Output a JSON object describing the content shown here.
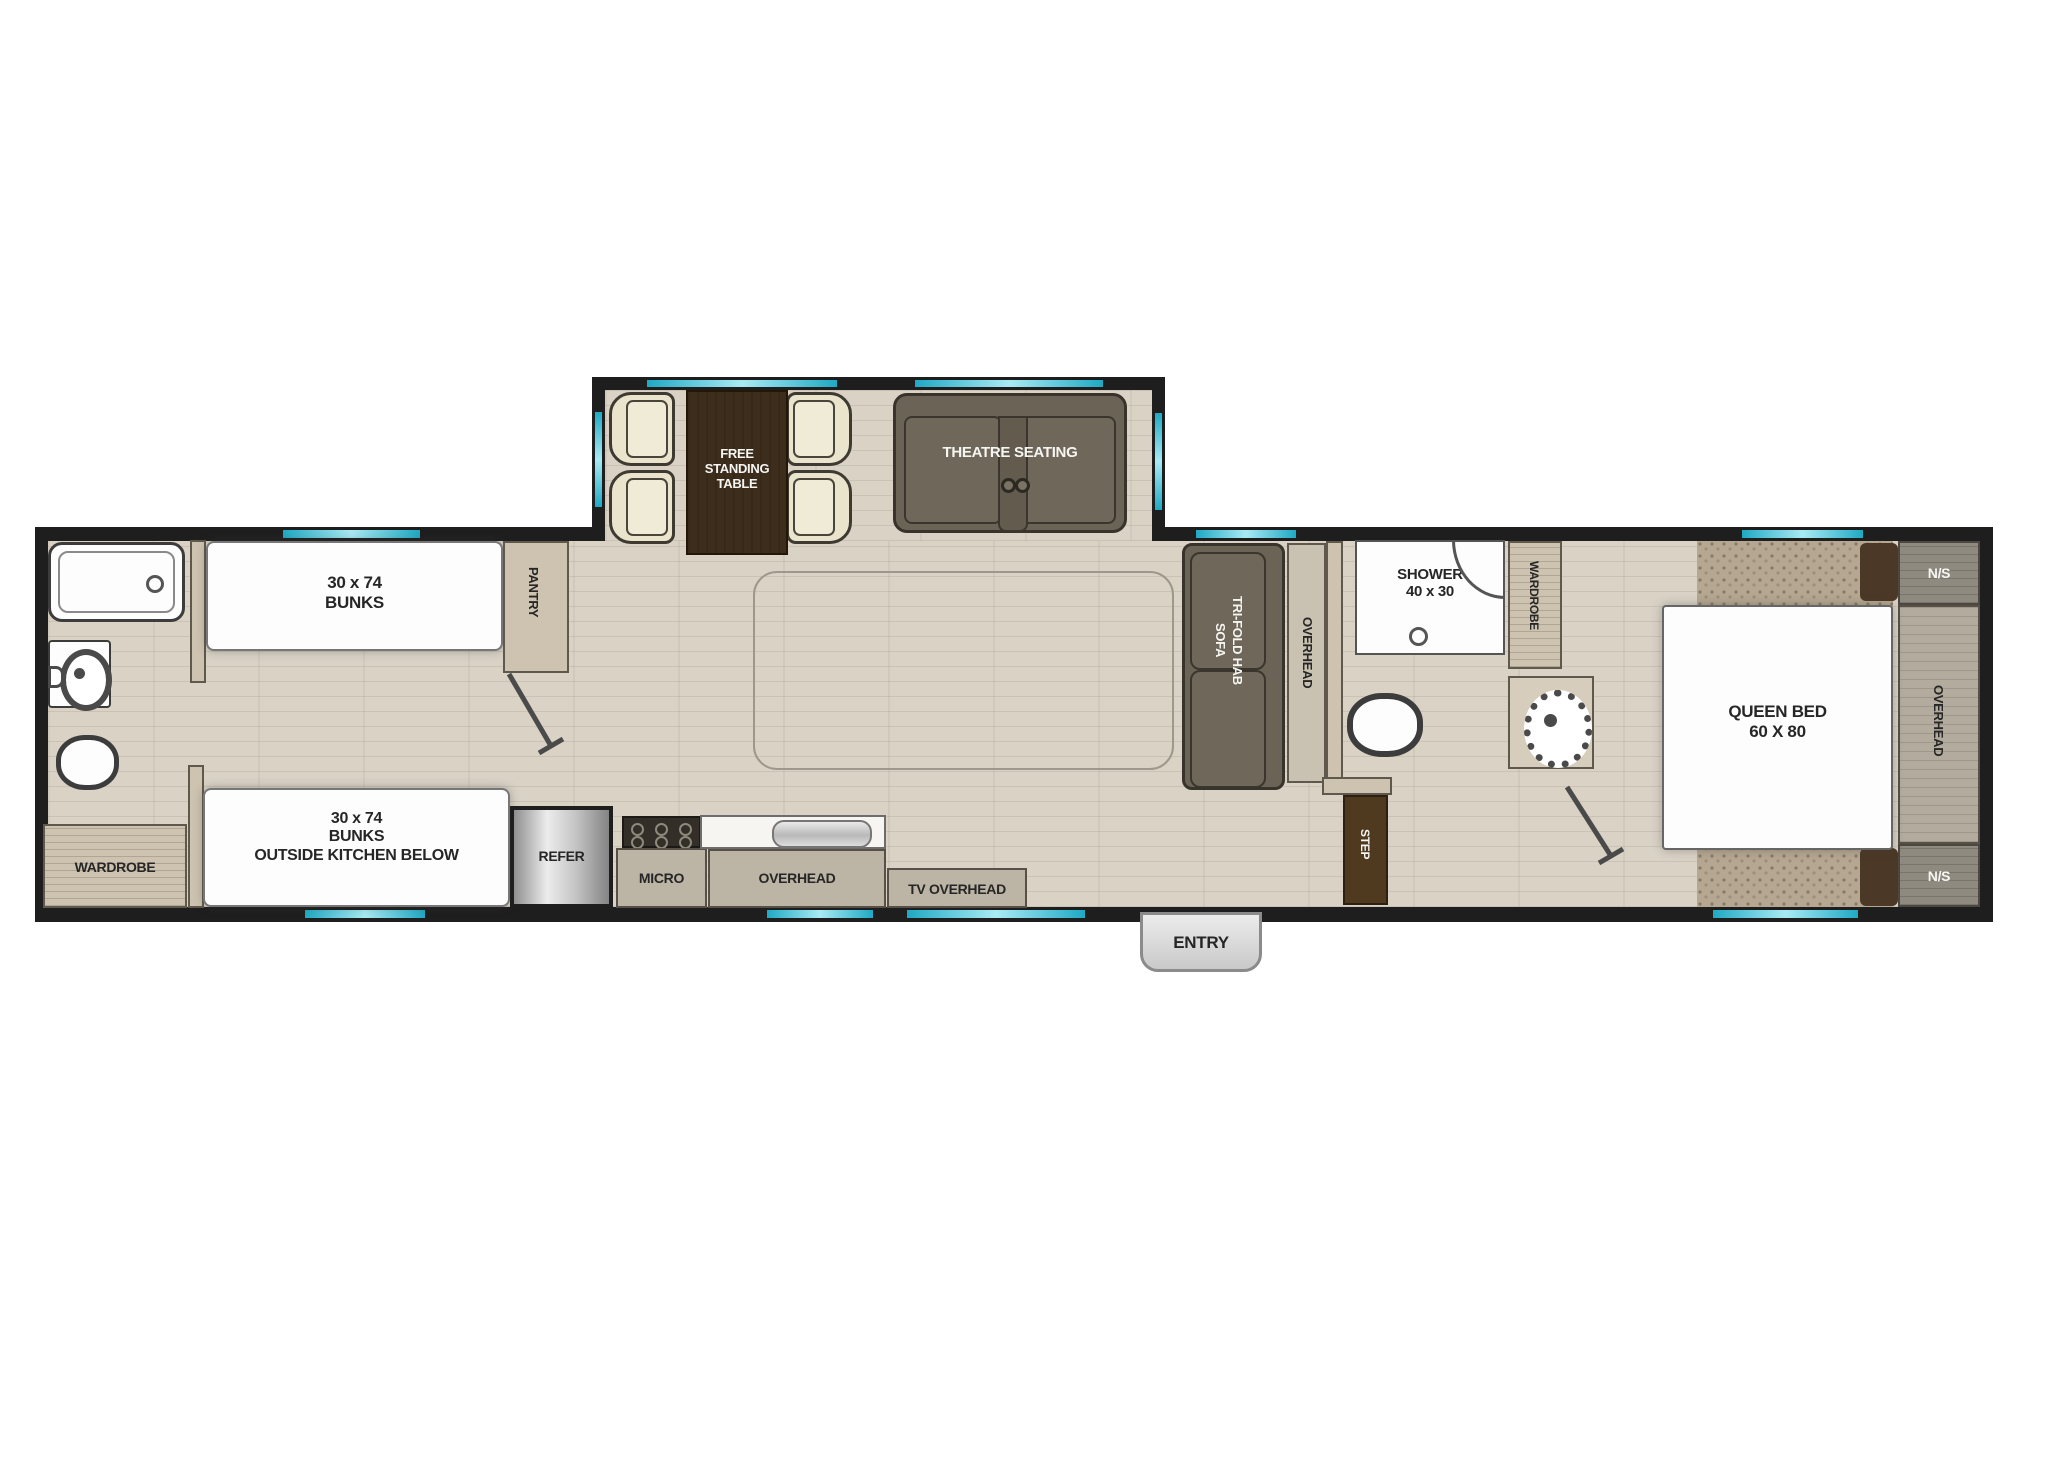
{
  "plan_title": "RV travel trailer floor plan",
  "colors": {
    "wall": "#1e1e1e",
    "window_teal": "#1fa9c4",
    "floor": "#d9d2c5",
    "carpet": "#b5a791",
    "table_wood": "#3c2d1d",
    "sofa_gray": "#6b6355",
    "chair_cream": "#e9e4cb",
    "cabinet": "#bcb4a5",
    "step_brown": "#4f3a20"
  },
  "labels": {
    "bunk_top": {
      "l1": "30 x 74",
      "l2": "BUNKS"
    },
    "bunk_bottom": {
      "l1": "30 x 74",
      "l2": "BUNKS",
      "l3": "OUTSIDE KITCHEN BELOW"
    },
    "wardrobe_left": "WARDROBE",
    "pantry": "PANTRY",
    "dinette": {
      "l1": "FREE",
      "l2": "STANDING",
      "l3": "TABLE"
    },
    "theatre": "THEATRE SEATING",
    "kitchen": {
      "refer": "REFER",
      "micro": "MICRO",
      "overhead": "OVERHEAD",
      "tv_overhead": "TV OVERHEAD"
    },
    "entry": "ENTRY",
    "step": "STEP",
    "sofa": {
      "l1": "TRI-FOLD HAB",
      "l2": "SOFA"
    },
    "sofa_overhead": "OVERHEAD",
    "bath": {
      "shower_l1": "SHOWER",
      "shower_l2": "40 x 30"
    },
    "wardrobe_bedroom": "WARDROBE",
    "bedroom": {
      "bed_l1": "QUEEN BED",
      "bed_l2": "60 X 80",
      "ns_top": "N/S",
      "ns_bottom": "N/S",
      "overhead": "OVERHEAD"
    }
  }
}
